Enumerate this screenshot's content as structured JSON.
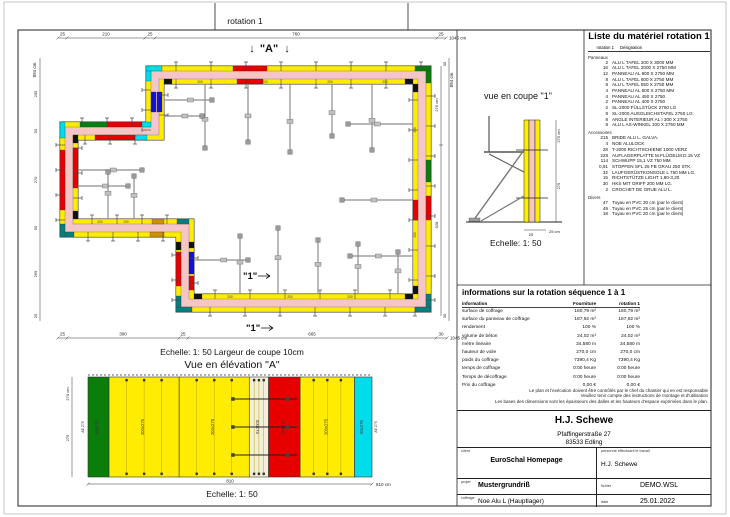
{
  "palette": {
    "wall_fill": "#f6c6c6",
    "panel_yellow": "#ffec00",
    "red": "#e60000",
    "green": "#0b7d0b",
    "cyan": "#00dcec",
    "blue": "#1010d8",
    "teal": "#077d7d",
    "orange": "#cf9000",
    "black": "#111111",
    "brace_gray": "#8d8d8d",
    "filler": "#f4f0d8"
  },
  "plan": {
    "title": "rotation 1",
    "marker_a": "\"A\"",
    "marker_1": "\"1\"",
    "scale_note": "Echelle: 1: 50   Largeur de coupe 10cm",
    "dims": {
      "top": {
        "segs": [
          "25",
          "210",
          "25",
          "760",
          "25"
        ],
        "total": "1045 cm"
      },
      "bottom": {
        "segs": [
          "25",
          "300",
          "25",
          "665",
          "30"
        ],
        "total": "1045 cm"
      },
      "left": {
        "total": "894 cm",
        "segs": [
          "25",
          "205",
          "50",
          "270",
          "50",
          "269",
          "25"
        ]
      },
      "right": {
        "total": "894 cm",
        "segs": [
          "30",
          "30"
        ],
        "inner": [
          "279 cm",
          "628"
        ]
      }
    },
    "segments": [
      {
        "x": 146,
        "y": 66,
        "w": 16,
        "h": 5,
        "c": "cyan"
      },
      {
        "x": 233,
        "y": 66,
        "w": 34,
        "h": 5,
        "c": "red"
      },
      {
        "x": 415,
        "y": 66,
        "w": 16,
        "h": 5,
        "c": "green"
      },
      {
        "x": 164,
        "y": 79,
        "w": 8,
        "h": 5,
        "c": "black"
      },
      {
        "x": 405,
        "y": 79,
        "w": 8,
        "h": 5,
        "c": "black"
      },
      {
        "x": 237,
        "y": 79,
        "w": 26,
        "h": 5,
        "c": "red"
      },
      {
        "x": 426,
        "y": 71,
        "w": 5,
        "h": 12,
        "c": "green"
      },
      {
        "x": 426,
        "y": 160,
        "w": 5,
        "h": 22,
        "c": "green"
      },
      {
        "x": 426,
        "y": 196,
        "w": 5,
        "h": 24,
        "c": "red"
      },
      {
        "x": 426,
        "y": 294,
        "w": 5,
        "h": 18,
        "c": "teal"
      },
      {
        "x": 413,
        "y": 84,
        "w": 5,
        "h": 8,
        "c": "black"
      },
      {
        "x": 413,
        "y": 200,
        "w": 5,
        "h": 20,
        "c": "red"
      },
      {
        "x": 413,
        "y": 286,
        "w": 5,
        "h": 8,
        "c": "black"
      },
      {
        "x": 176,
        "y": 307,
        "w": 16,
        "h": 5,
        "c": "teal"
      },
      {
        "x": 415,
        "y": 307,
        "w": 16,
        "h": 5,
        "c": "teal"
      },
      {
        "x": 194,
        "y": 294,
        "w": 8,
        "h": 5,
        "c": "black"
      },
      {
        "x": 405,
        "y": 294,
        "w": 8,
        "h": 5,
        "c": "black"
      },
      {
        "x": 176,
        "y": 242,
        "w": 5,
        "h": 8,
        "c": "black"
      },
      {
        "x": 176,
        "y": 252,
        "w": 5,
        "h": 34,
        "c": "red"
      },
      {
        "x": 176,
        "y": 296,
        "w": 5,
        "h": 11,
        "c": "teal"
      },
      {
        "x": 189,
        "y": 242,
        "w": 5,
        "h": 6,
        "c": "black"
      },
      {
        "x": 189,
        "y": 252,
        "w": 5,
        "h": 22,
        "c": "blue"
      },
      {
        "x": 189,
        "y": 276,
        "w": 5,
        "h": 14,
        "c": "red"
      },
      {
        "x": 60,
        "y": 232,
        "w": 14,
        "h": 5,
        "c": "teal"
      },
      {
        "x": 150,
        "y": 232,
        "w": 14,
        "h": 5,
        "c": "orange"
      },
      {
        "x": 152,
        "y": 219,
        "w": 12,
        "h": 5,
        "c": "orange"
      },
      {
        "x": 177,
        "y": 219,
        "w": 12,
        "h": 5,
        "c": "teal"
      },
      {
        "x": 60,
        "y": 122,
        "w": 5,
        "h": 16,
        "c": "cyan"
      },
      {
        "x": 60,
        "y": 150,
        "w": 5,
        "h": 60,
        "c": "red"
      },
      {
        "x": 60,
        "y": 224,
        "w": 5,
        "h": 13,
        "c": "teal"
      },
      {
        "x": 73,
        "y": 135,
        "w": 5,
        "h": 8,
        "c": "black"
      },
      {
        "x": 73,
        "y": 148,
        "w": 5,
        "h": 40,
        "c": "red"
      },
      {
        "x": 73,
        "y": 211,
        "w": 5,
        "h": 8,
        "c": "black"
      },
      {
        "x": 80,
        "y": 122,
        "w": 28,
        "h": 5,
        "c": "green"
      },
      {
        "x": 108,
        "y": 122,
        "w": 36,
        "h": 5,
        "c": "red"
      },
      {
        "x": 142,
        "y": 122,
        "w": 9,
        "h": 5,
        "c": "cyan"
      },
      {
        "x": 95,
        "y": 135,
        "w": 40,
        "h": 5,
        "c": "red"
      },
      {
        "x": 135,
        "y": 135,
        "w": 12,
        "h": 5,
        "c": "cyan"
      },
      {
        "x": 146,
        "y": 71,
        "w": 5,
        "h": 10,
        "c": "cyan"
      },
      {
        "x": 151,
        "y": 92,
        "w": 5,
        "h": 20,
        "c": "blue"
      },
      {
        "x": 157,
        "y": 92,
        "w": 5,
        "h": 20,
        "c": "blue"
      }
    ],
    "joints": [
      {
        "o": "h",
        "b": [
          66,
          71
        ],
        "out": -1,
        "p": [
          176,
          211,
          246,
          281,
          316,
          351,
          386,
          421
        ]
      },
      {
        "o": "h",
        "b": [
          79,
          84
        ],
        "out": 1,
        "p": [
          176,
          211,
          246,
          281,
          316,
          351,
          386
        ]
      },
      {
        "o": "v",
        "b": [
          426,
          431
        ],
        "out": 1,
        "p": [
          96,
          126,
          156,
          186,
          216,
          246,
          276,
          300
        ]
      },
      {
        "o": "v",
        "b": [
          413,
          418
        ],
        "out": -1,
        "p": [
          100,
          130,
          160,
          190,
          220,
          250,
          280
        ]
      },
      {
        "o": "h",
        "b": [
          307,
          312
        ],
        "out": 1,
        "p": [
          210,
          245,
          280,
          315,
          350,
          385,
          415
        ]
      },
      {
        "o": "h",
        "b": [
          294,
          299
        ],
        "out": -1,
        "p": [
          215,
          250,
          285,
          320,
          355,
          390
        ]
      },
      {
        "o": "v",
        "b": [
          60,
          65
        ],
        "out": -1,
        "p": [
          145,
          170,
          195,
          220
        ]
      },
      {
        "o": "v",
        "b": [
          73,
          78
        ],
        "out": 1,
        "p": [
          148,
          173,
          198
        ]
      },
      {
        "o": "h",
        "b": [
          232,
          237
        ],
        "out": 1,
        "p": [
          88,
          113,
          138,
          163
        ]
      },
      {
        "o": "h",
        "b": [
          219,
          224
        ],
        "out": -1,
        "p": [
          92,
          117,
          142,
          167
        ]
      },
      {
        "o": "h",
        "b": [
          122,
          127
        ],
        "out": -1,
        "p": [
          82,
          107,
          132
        ]
      },
      {
        "o": "h",
        "b": [
          135,
          140
        ],
        "out": 1,
        "p": [
          85,
          110,
          135
        ]
      },
      {
        "o": "v",
        "b": [
          176,
          181
        ],
        "out": -1,
        "p": [
          255,
          280,
          300
        ]
      },
      {
        "o": "v",
        "b": [
          189,
          194
        ],
        "out": 1,
        "p": [
          258,
          283
        ]
      },
      {
        "o": "v",
        "b": [
          146,
          151
        ],
        "out": -1,
        "p": [
          90,
          110,
          130
        ]
      },
      {
        "o": "v",
        "b": [
          159,
          164
        ],
        "out": 1,
        "p": [
          95,
          115
        ]
      }
    ],
    "braces": [
      [
        205,
        84,
        205,
        148
      ],
      [
        248,
        84,
        248,
        142
      ],
      [
        290,
        84,
        290,
        152
      ],
      [
        332,
        84,
        332,
        136
      ],
      [
        372,
        84,
        372,
        150
      ],
      [
        413,
        124,
        348,
        124
      ],
      [
        413,
        200,
        342,
        200
      ],
      [
        413,
        256,
        350,
        256
      ],
      [
        240,
        294,
        240,
        236
      ],
      [
        278,
        294,
        278,
        228
      ],
      [
        318,
        294,
        318,
        240
      ],
      [
        358,
        294,
        358,
        244
      ],
      [
        398,
        294,
        398,
        252
      ],
      [
        78,
        170,
        142,
        170
      ],
      [
        78,
        186,
        128,
        186
      ],
      [
        108,
        219,
        108,
        172
      ],
      [
        134,
        219,
        134,
        176
      ],
      [
        194,
        260,
        248,
        260
      ],
      [
        164,
        100,
        212,
        100
      ],
      [
        164,
        116,
        202,
        116
      ]
    ],
    "labels": [
      {
        "x": 200,
        "y": 82.8,
        "t": "200"
      },
      {
        "x": 265,
        "y": 82.8,
        "t": "200"
      },
      {
        "x": 330,
        "y": 82.8,
        "t": "200"
      },
      {
        "x": 385,
        "y": 82.8,
        "t": "200"
      },
      {
        "x": 230,
        "y": 297.8,
        "t": "200"
      },
      {
        "x": 290,
        "y": 297.8,
        "t": "200"
      },
      {
        "x": 350,
        "y": 297.8,
        "t": "200"
      },
      {
        "x": 100,
        "y": 222.8,
        "t": "200"
      },
      {
        "x": 126,
        "y": 222.8,
        "t": "200"
      }
    ],
    "rlabels": [
      {
        "x": 416,
        "y": 130,
        "t": "200"
      },
      {
        "x": 416,
        "y": 235,
        "t": "200"
      }
    ]
  },
  "coupe": {
    "title": "vue en coupe \"1\"",
    "scale": "Echelle: 1: 50",
    "dims": {
      "right_total": "275 cm",
      "right": "275",
      "bottom": "25",
      "bottom_total": "25 cm"
    }
  },
  "elevation": {
    "title": "Vue en élévation \"A\"",
    "scale": "Echelle: 1: 50",
    "end_label": "AE 275",
    "dims": {
      "left_top": "270 cm",
      "left": "275",
      "width": "810",
      "width_total": "810 cm"
    },
    "panels": [
      {
        "w": 60,
        "c": "green",
        "label": "60x275"
      },
      {
        "w": 200,
        "c": "panel_yellow",
        "label": "200x275"
      },
      {
        "w": 200,
        "c": "panel_yellow",
        "label": "200x275"
      },
      {
        "w": 55,
        "c": "filler",
        "label": "SL2000"
      },
      {
        "w": 90,
        "c": "red",
        "label": "90x275",
        "ties": [
          0.22,
          0.5,
          0.78
        ]
      },
      {
        "w": 155,
        "c": "panel_yellow",
        "label": "200x275"
      },
      {
        "w": 50,
        "c": "cyan",
        "label": "50x275"
      }
    ]
  },
  "material_list": {
    "title": "Liste du matériel  rotation 1",
    "col_qty": "rotation 1",
    "col_name": "Désignation",
    "groups": [
      {
        "name": "Panneaux",
        "items": [
          {
            "qty": "2",
            "name": "ALU L TAFEL 200 X 3000 MM"
          },
          {
            "qty": "16",
            "name": "ALU L TAFEL 2000 X 2750 MM"
          },
          {
            "qty": "12",
            "name": "PANNEAU AL 900 X 2750 MM"
          },
          {
            "qty": "8",
            "name": "ALU L TAFEL 600 X 2750 MM"
          },
          {
            "qty": "8",
            "name": "ALU L TAFEL 550 X 2750 MM"
          },
          {
            "qty": "4",
            "name": "PANNEAU AL 500 X 2750 MM"
          },
          {
            "qty": "4",
            "name": "PANNEAU AL 450 X 2750"
          },
          {
            "qty": "2",
            "name": "PANNEAU AL 400 X 2750"
          },
          {
            "qty": "2",
            "name": "SL-2000 FÜLLSTÜCK 2750 LG"
          },
          {
            "qty": "8",
            "name": "SL-2000 AUSGLEICHSTAFEL 2750 LG"
          },
          {
            "qty": "8",
            "name": "ANGLE INTERIEUR AL I 300 X 2750"
          },
          {
            "qty": "8",
            "name": "ALU L AS-WINKEL 100 X 2750 MM"
          }
        ]
      },
      {
        "name": "Accessoires",
        "items": [
          {
            "qty": "215",
            "name": "BRIDE ALU L. GALVA."
          },
          {
            "qty": "4",
            "name": "NOE ALULOCK"
          },
          {
            "qty": "28",
            "name": "T-2000 RICHTSCHIENE 1000 VERZ"
          },
          {
            "qty": "228",
            "name": "AUFLAGERPLATTE M.FLÜGELM.D.15 VZ"
          },
          {
            "qty": "114",
            "name": "SCHWUPP 15,1 VZ 750 MM"
          },
          {
            "qty": "0,91",
            "name": "STOPFEN SFL 25 FB GRAU 250 STK."
          },
          {
            "qty": "32",
            "name": "LAUFGERÜSTKONSOLE L 750 MM LG."
          },
          {
            "qty": "15",
            "name": "RICHTSTÜTZE LIGHT 1,80-3,20"
          },
          {
            "qty": "30",
            "name": "HKS MIT GRIFF 200 MM LG."
          },
          {
            "qty": "2",
            "name": "CROCHET DE GRUE ALU L."
          }
        ]
      },
      {
        "name": "Divers",
        "items": [
          {
            "qty": "47",
            "name": "Tuyau en PVC 30 cm (par le client)"
          },
          {
            "qty": "49",
            "name": "Tuyau en PVC 25 cm (par le client)"
          },
          {
            "qty": "18",
            "name": "Tuyau en PVC 20 cm (par le client)"
          }
        ]
      }
    ]
  },
  "info": {
    "title": "informations sur la rotation  séquence 1 à 1",
    "columns": [
      "information",
      "Fourniture",
      "rotation 1"
    ],
    "rows": [
      [
        "surface de coffrage",
        "180,79 m²",
        "180,79 m²"
      ],
      [
        "surface du panneau de coffrage",
        "187,92 m²",
        "187,92 m²"
      ],
      [
        "rendement",
        "100 %",
        "100 %"
      ],
      [
        "volume de béton",
        "24,02 m³",
        "24,02 m³"
      ],
      [
        "mètre linéaire",
        "34,580 m",
        "34,580 m"
      ],
      [
        "hauteur de voile",
        "270,0 cm",
        "270,0 cm"
      ],
      [
        "poids du coffrage",
        "7390,4 Kg",
        "7390,4 Kg"
      ],
      [
        "temps de coffrage",
        "0:00 heure",
        "0:00 heure"
      ],
      [
        "Temps de décoffrage",
        "0:00 heure",
        "0:00 heure"
      ],
      [
        "Prix du coffrage",
        "0,00 €",
        "0,00 €"
      ]
    ],
    "disclaimer": [
      "Le plan et l'exécution doivent être contrôlés par le chef du chantier qui en est responsable",
      "Veuillez tenir compte des instructions de montage et d'utilisation",
      "Les bases des dimensions sont les épaisseurs des dalles et les hauteurs d'espace exprimées dans le plan."
    ]
  },
  "title_block": {
    "company": "H.J. Schewe",
    "address1": "Pfaffingerstraße 27",
    "address2": "83533 Edling",
    "client_label": "client",
    "client_value": "EuroSchal Homepage",
    "worker_label": "personne effectuant le travail",
    "worker_value": "H.J. Schewe",
    "project_label": "projet",
    "project_value": "Mustergrundriß",
    "file_label": "fichier",
    "file_value": "DEMO.WSL",
    "formwork_label": "coffrage",
    "formwork_value": "Noe Alu L (Hauptlager)",
    "date_label": "date",
    "date_value": "25.01.2022"
  }
}
